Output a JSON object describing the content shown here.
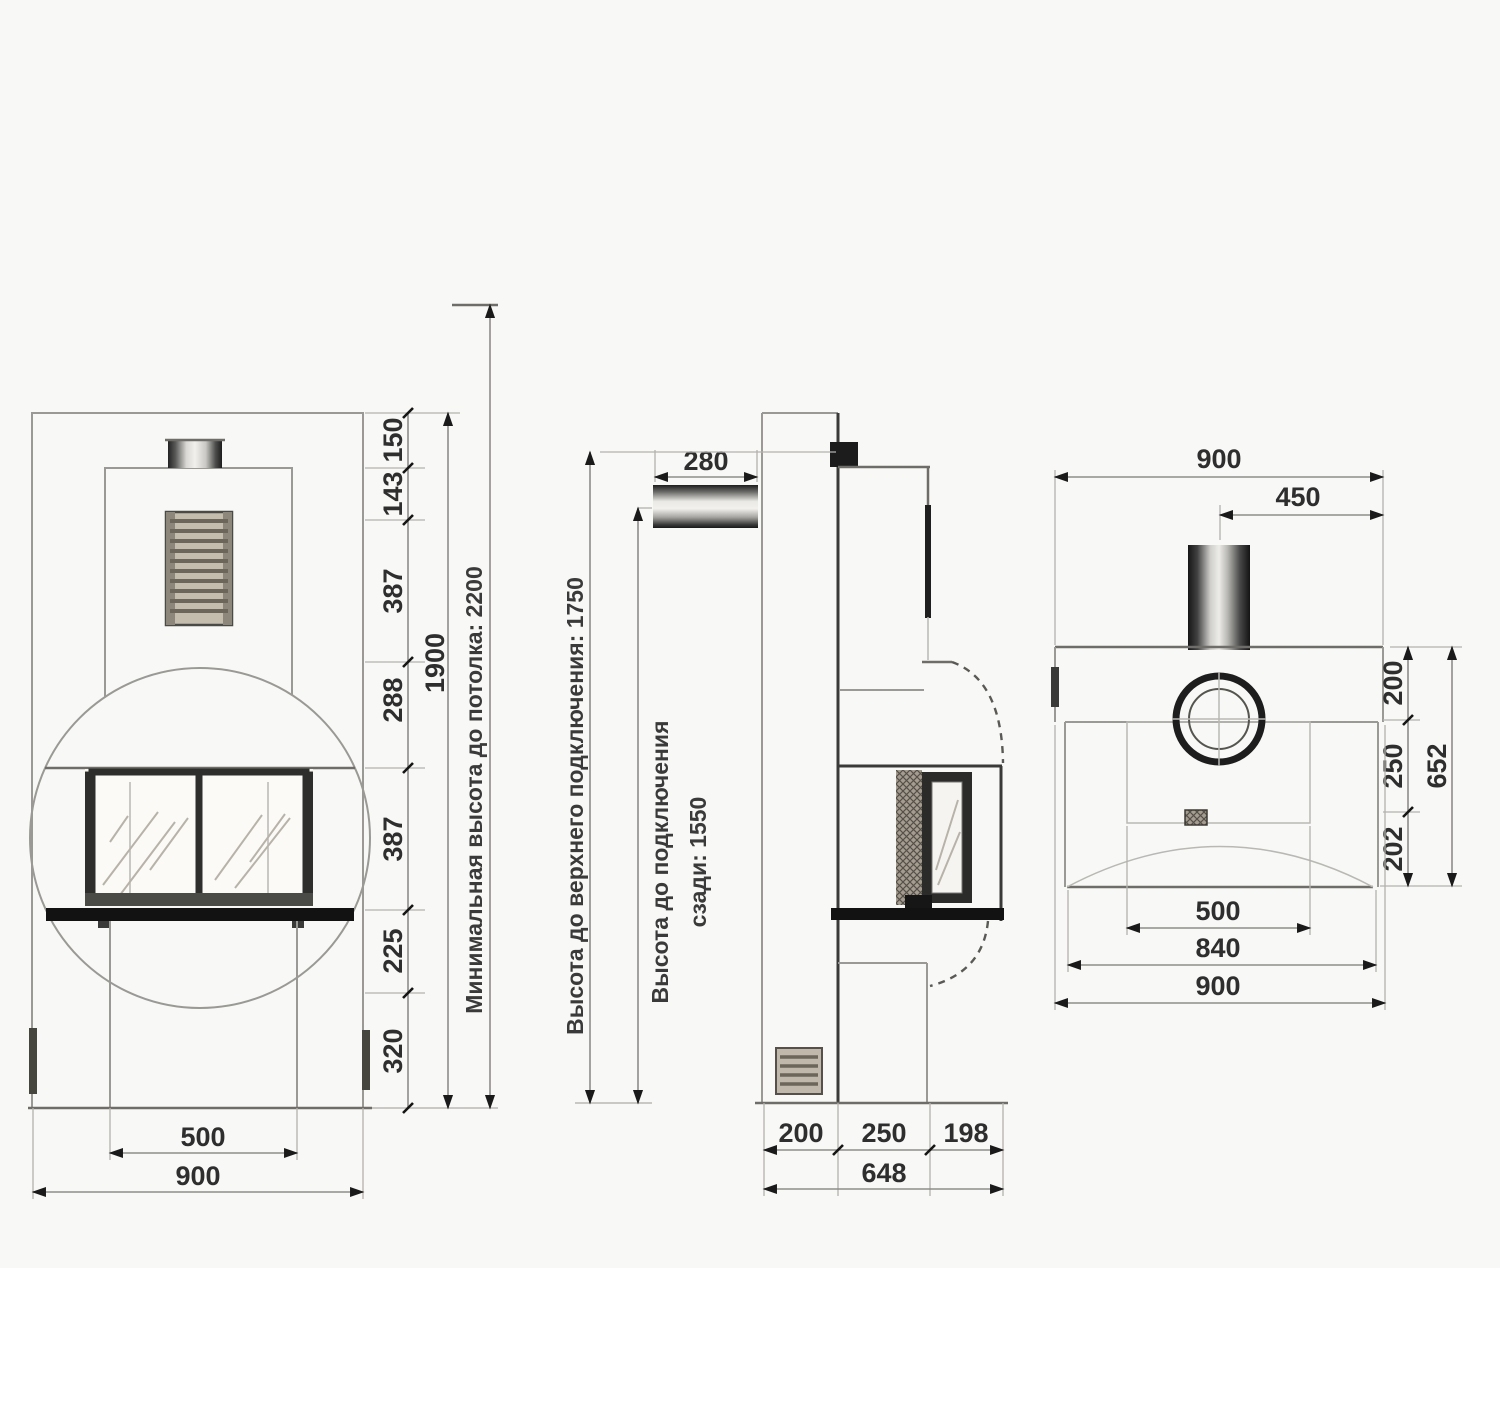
{
  "meta": {
    "drawing_type": "fireplace installation dimension drawing, three views",
    "units": "mm"
  },
  "front_view": {
    "chain": [
      "150",
      "143",
      "387",
      "288",
      "387",
      "225",
      "320"
    ],
    "total_height": "1900",
    "ceiling_note": "Минимальная высота до потолка: 2200",
    "hearth_width": "500",
    "overall_width": "900"
  },
  "side_view": {
    "flue_stub_length": "280",
    "top_connection_note": "Высота до верхнего подключения: 1750",
    "rear_connection_note_line1": "Высота до подключения",
    "rear_connection_note_line2": "сзади: 1550",
    "depth_segments": [
      "200",
      "250",
      "198"
    ],
    "overall_depth": "648"
  },
  "rear_view": {
    "overall_width_top": "900",
    "flue_offset": "450",
    "depth_segments": [
      "200",
      "250",
      "202"
    ],
    "overall_depth": "652",
    "hearth_width": "500",
    "body_width": "840",
    "overall_width_bottom": "900"
  }
}
